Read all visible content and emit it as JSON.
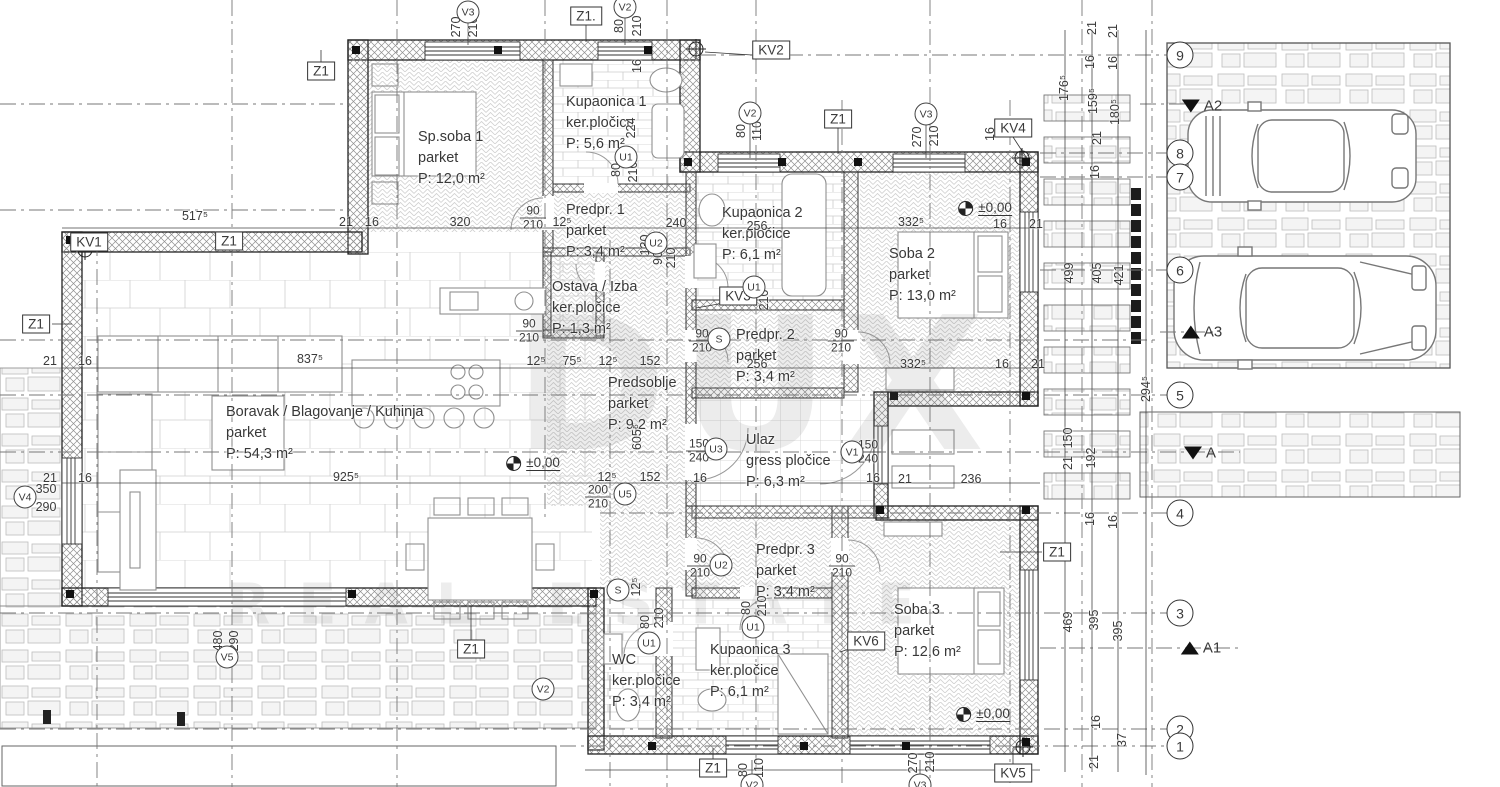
{
  "drawing": {
    "watermark": {
      "line1": "DUX",
      "line2": "REAL ESTATE"
    },
    "colors": {
      "line": "#2f2f2f",
      "pattern": "#cfcfcf",
      "stone_fill": "#f4f4f4",
      "text": "#3a3a3a"
    },
    "rooms": [
      {
        "id": "sp-soba-1",
        "name": "Sp.soba 1",
        "floor": "parket",
        "area": "P: 12,0 m²",
        "x": 418,
        "y": 127
      },
      {
        "id": "kupaonica-1",
        "name": "Kupaonica 1",
        "floor": "ker.pločice",
        "area": "P: 5,6 m²",
        "x": 566,
        "y": 92
      },
      {
        "id": "predpr-1",
        "name": "Predpr. 1",
        "floor": "parket",
        "area": "P: 3,4 m²",
        "x": 566,
        "y": 200
      },
      {
        "id": "kupaonica-2",
        "name": "Kupaonica 2",
        "floor": "ker.pločice",
        "area": "P: 6,1 m²",
        "x": 722,
        "y": 203
      },
      {
        "id": "soba-2",
        "name": "Soba 2",
        "floor": "parket",
        "area": "P: 13,0 m²",
        "x": 889,
        "y": 244
      },
      {
        "id": "predpr-2",
        "name": "Predpr. 2",
        "floor": "parket",
        "area": "P: 3,4 m²",
        "x": 736,
        "y": 325
      },
      {
        "id": "ostava-izba",
        "name": "Ostava / Izba",
        "floor": "ker.pločice",
        "area": "P: 1,3 m²",
        "x": 552,
        "y": 277
      },
      {
        "id": "predsoblje",
        "name": "Predsoblje",
        "floor": "parket",
        "area": "P: 9,2 m²",
        "x": 608,
        "y": 373
      },
      {
        "id": "ulaz",
        "name": "Ulaz",
        "floor": "gress pločice",
        "area": "P: 6,3 m²",
        "x": 746,
        "y": 430
      },
      {
        "id": "boravak",
        "name": "Boravak / Blagovanje / Kuhinja",
        "floor": "parket",
        "area": "P: 54,3 m²",
        "x": 226,
        "y": 402
      },
      {
        "id": "predpr-3",
        "name": "Predpr. 3",
        "floor": "parket",
        "area": "P: 3,4 m²",
        "x": 756,
        "y": 540
      },
      {
        "id": "soba-3",
        "name": "Soba 3",
        "floor": "parket",
        "area": "P: 12,6 m²",
        "x": 894,
        "y": 600
      },
      {
        "id": "wc",
        "name": "WC",
        "floor": "ker.pločice",
        "area": "P: 3,4 m²",
        "x": 612,
        "y": 650
      },
      {
        "id": "kupaonica-3",
        "name": "Kupaonica 3",
        "floor": "ker.pločice",
        "area": "P: 6,1 m²",
        "x": 710,
        "y": 640
      }
    ],
    "dims_h": [
      {
        "t": "517⁵",
        "x": 195,
        "y": 216
      },
      {
        "t": "21",
        "x": 346,
        "y": 222
      },
      {
        "t": "16",
        "x": 372,
        "y": 222
      },
      {
        "t": "320",
        "x": 460,
        "y": 222
      },
      {
        "t": "12⁵",
        "x": 562,
        "y": 222
      },
      {
        "t": "240",
        "x": 676,
        "y": 223
      },
      {
        "t": "332⁵",
        "x": 911,
        "y": 222
      },
      {
        "t": "16",
        "x": 1000,
        "y": 224
      },
      {
        "t": "21",
        "x": 1036,
        "y": 224
      },
      {
        "t": "256",
        "x": 757,
        "y": 226
      },
      {
        "t": "837⁵",
        "x": 310,
        "y": 359
      },
      {
        "t": "12⁵",
        "x": 536,
        "y": 361
      },
      {
        "t": "75⁵",
        "x": 572,
        "y": 361
      },
      {
        "t": "12⁵",
        "x": 608,
        "y": 361
      },
      {
        "t": "152",
        "x": 650,
        "y": 361
      },
      {
        "t": "256",
        "x": 757,
        "y": 364
      },
      {
        "t": "332⁵",
        "x": 913,
        "y": 364
      },
      {
        "t": "16",
        "x": 1002,
        "y": 364
      },
      {
        "t": "21",
        "x": 1038,
        "y": 364
      },
      {
        "t": "21",
        "x": 50,
        "y": 361
      },
      {
        "t": "16",
        "x": 85,
        "y": 361
      },
      {
        "t": "925⁵",
        "x": 346,
        "y": 477
      },
      {
        "t": "12⁵",
        "x": 607,
        "y": 477
      },
      {
        "t": "152",
        "x": 650,
        "y": 477
      },
      {
        "t": "16",
        "x": 700,
        "y": 478
      },
      {
        "t": "16",
        "x": 873,
        "y": 478
      },
      {
        "t": "21",
        "x": 905,
        "y": 479
      },
      {
        "t": "236",
        "x": 971,
        "y": 479
      },
      {
        "t": "21",
        "x": 50,
        "y": 478
      },
      {
        "t": "16",
        "x": 85,
        "y": 478
      },
      {
        "t": "350",
        "x": 46,
        "y": 489
      },
      {
        "t": "290",
        "x": 46,
        "y": 507
      }
    ],
    "dims_v": [
      {
        "t": "270",
        "x": 456,
        "y": 27
      },
      {
        "t": "210",
        "x": 473,
        "y": 27
      },
      {
        "t": "80",
        "x": 619,
        "y": 26
      },
      {
        "t": "210",
        "x": 637,
        "y": 26
      },
      {
        "t": "16",
        "x": 637,
        "y": 66
      },
      {
        "t": "224",
        "x": 631,
        "y": 128
      },
      {
        "t": "80",
        "x": 616,
        "y": 170
      },
      {
        "t": "210",
        "x": 633,
        "y": 172
      },
      {
        "t": "130",
        "x": 645,
        "y": 245
      },
      {
        "t": "90",
        "x": 658,
        "y": 258
      },
      {
        "t": "210",
        "x": 671,
        "y": 258
      },
      {
        "t": "80",
        "x": 741,
        "y": 131
      },
      {
        "t": "110",
        "x": 757,
        "y": 131
      },
      {
        "t": "270",
        "x": 917,
        "y": 137
      },
      {
        "t": "210",
        "x": 934,
        "y": 136
      },
      {
        "t": "16",
        "x": 990,
        "y": 134
      },
      {
        "t": "210",
        "x": 764,
        "y": 300
      },
      {
        "t": "605⁵",
        "x": 637,
        "y": 437
      },
      {
        "t": "12⁵",
        "x": 636,
        "y": 587
      },
      {
        "t": "80",
        "x": 645,
        "y": 622
      },
      {
        "t": "210",
        "x": 659,
        "y": 618
      },
      {
        "t": "80",
        "x": 746,
        "y": 608
      },
      {
        "t": "210",
        "x": 762,
        "y": 606
      },
      {
        "t": "480",
        "x": 218,
        "y": 641
      },
      {
        "t": "290",
        "x": 234,
        "y": 641
      },
      {
        "t": "80",
        "x": 743,
        "y": 770
      },
      {
        "t": "110",
        "x": 759,
        "y": 768
      },
      {
        "t": "270",
        "x": 913,
        "y": 763
      },
      {
        "t": "210",
        "x": 930,
        "y": 762
      },
      {
        "t": "21",
        "x": 1092,
        "y": 28
      },
      {
        "t": "21",
        "x": 1113,
        "y": 31
      },
      {
        "t": "16",
        "x": 1090,
        "y": 62
      },
      {
        "t": "16",
        "x": 1113,
        "y": 63
      },
      {
        "t": "176⁵",
        "x": 1064,
        "y": 88
      },
      {
        "t": "159⁵",
        "x": 1093,
        "y": 101
      },
      {
        "t": "180⁵",
        "x": 1115,
        "y": 112
      },
      {
        "t": "21",
        "x": 1097,
        "y": 138
      },
      {
        "t": "16",
        "x": 1095,
        "y": 172
      },
      {
        "t": "499",
        "x": 1069,
        "y": 273
      },
      {
        "t": "405",
        "x": 1097,
        "y": 273
      },
      {
        "t": "421",
        "x": 1119,
        "y": 275
      },
      {
        "t": "294⁵",
        "x": 1146,
        "y": 389
      },
      {
        "t": "150",
        "x": 1068,
        "y": 438
      },
      {
        "t": "21",
        "x": 1068,
        "y": 463
      },
      {
        "t": "192",
        "x": 1091,
        "y": 458
      },
      {
        "t": "16",
        "x": 1090,
        "y": 519
      },
      {
        "t": "16",
        "x": 1113,
        "y": 522
      },
      {
        "t": "469",
        "x": 1068,
        "y": 622
      },
      {
        "t": "395",
        "x": 1094,
        "y": 620
      },
      {
        "t": "395",
        "x": 1118,
        "y": 631
      },
      {
        "t": "16",
        "x": 1096,
        "y": 722
      },
      {
        "t": "37",
        "x": 1122,
        "y": 740
      },
      {
        "t": "21",
        "x": 1094,
        "y": 762
      }
    ],
    "fracs": [
      {
        "top": "90",
        "bottom": "210",
        "x": 533,
        "y": 218
      },
      {
        "top": "90",
        "bottom": "210",
        "x": 529,
        "y": 331
      },
      {
        "top": "90",
        "bottom": "210",
        "x": 702,
        "y": 341
      },
      {
        "top": "90",
        "bottom": "210",
        "x": 841,
        "y": 341
      },
      {
        "top": "150",
        "bottom": "240",
        "x": 699,
        "y": 451
      },
      {
        "top": "150",
        "bottom": "240",
        "x": 868,
        "y": 452
      },
      {
        "top": "200",
        "bottom": "210",
        "x": 598,
        "y": 497
      },
      {
        "top": "90",
        "bottom": "210",
        "x": 700,
        "y": 566
      },
      {
        "top": "90",
        "bottom": "210",
        "x": 842,
        "y": 566
      }
    ],
    "marker_boxes": [
      {
        "t": "Z1.",
        "x": 586,
        "y": 16
      },
      {
        "t": "KV2",
        "x": 771,
        "y": 50
      },
      {
        "t": "Z1",
        "x": 321,
        "y": 71
      },
      {
        "t": "Z1",
        "x": 838,
        "y": 119
      },
      {
        "t": "KV4",
        "x": 1013,
        "y": 128
      },
      {
        "t": "KV1",
        "x": 89,
        "y": 242
      },
      {
        "t": "Z1",
        "x": 229,
        "y": 241
      },
      {
        "t": "Z1",
        "x": 36,
        "y": 324
      },
      {
        "t": "KV3",
        "x": 738,
        "y": 296
      },
      {
        "t": "Z1",
        "x": 1057,
        "y": 552
      },
      {
        "t": "KV6",
        "x": 866,
        "y": 641
      },
      {
        "t": "Z1",
        "x": 471,
        "y": 649
      },
      {
        "t": "Z1",
        "x": 713,
        "y": 768
      },
      {
        "t": "KV5",
        "x": 1013,
        "y": 773
      }
    ],
    "marker_circles": [
      {
        "t": "V3",
        "x": 468,
        "y": 12
      },
      {
        "t": "V2",
        "x": 625,
        "y": 7
      },
      {
        "t": "V2",
        "x": 750,
        "y": 113
      },
      {
        "t": "V3",
        "x": 926,
        "y": 114
      },
      {
        "t": "U1",
        "x": 626,
        "y": 157
      },
      {
        "t": "U2",
        "x": 656,
        "y": 243
      },
      {
        "t": "U1",
        "x": 754,
        "y": 287
      },
      {
        "t": "S",
        "x": 719,
        "y": 339
      },
      {
        "t": "U3",
        "x": 716,
        "y": 449
      },
      {
        "t": "V1",
        "x": 852,
        "y": 452
      },
      {
        "t": "U5",
        "x": 625,
        "y": 494
      },
      {
        "t": "S",
        "x": 618,
        "y": 590
      },
      {
        "t": "U2",
        "x": 721,
        "y": 565
      },
      {
        "t": "U1",
        "x": 753,
        "y": 627
      },
      {
        "t": "U1",
        "x": 649,
        "y": 643
      },
      {
        "t": "V2",
        "x": 543,
        "y": 689
      },
      {
        "t": "V4",
        "x": 25,
        "y": 497
      },
      {
        "t": "V5",
        "x": 227,
        "y": 657
      },
      {
        "t": "V2",
        "x": 752,
        "y": 785
      },
      {
        "t": "V3",
        "x": 920,
        "y": 785
      }
    ],
    "grid_bubbles": [
      {
        "n": "9",
        "x": 1180,
        "y": 55
      },
      {
        "n": "8",
        "x": 1180,
        "y": 153
      },
      {
        "n": "7",
        "x": 1180,
        "y": 177
      },
      {
        "n": "6",
        "x": 1180,
        "y": 270
      },
      {
        "n": "5",
        "x": 1180,
        "y": 395
      },
      {
        "n": "4",
        "x": 1180,
        "y": 513
      },
      {
        "n": "3",
        "x": 1180,
        "y": 613
      },
      {
        "n": "2",
        "x": 1180,
        "y": 729
      },
      {
        "n": "1",
        "x": 1180,
        "y": 746
      }
    ],
    "section_markers": [
      {
        "label": "A2",
        "dir": "down",
        "x": 1202,
        "y": 106
      },
      {
        "label": "A3",
        "dir": "up",
        "x": 1202,
        "y": 332
      },
      {
        "label": "A",
        "dir": "down",
        "x": 1200,
        "y": 453
      },
      {
        "label": "A1",
        "dir": "up",
        "x": 1201,
        "y": 648
      }
    ],
    "level_markers": [
      {
        "t": "±0,00",
        "x": 985,
        "y": 208
      },
      {
        "t": "±0,00",
        "x": 533,
        "y": 463
      },
      {
        "t": "±0,00",
        "x": 983,
        "y": 714
      }
    ]
  }
}
